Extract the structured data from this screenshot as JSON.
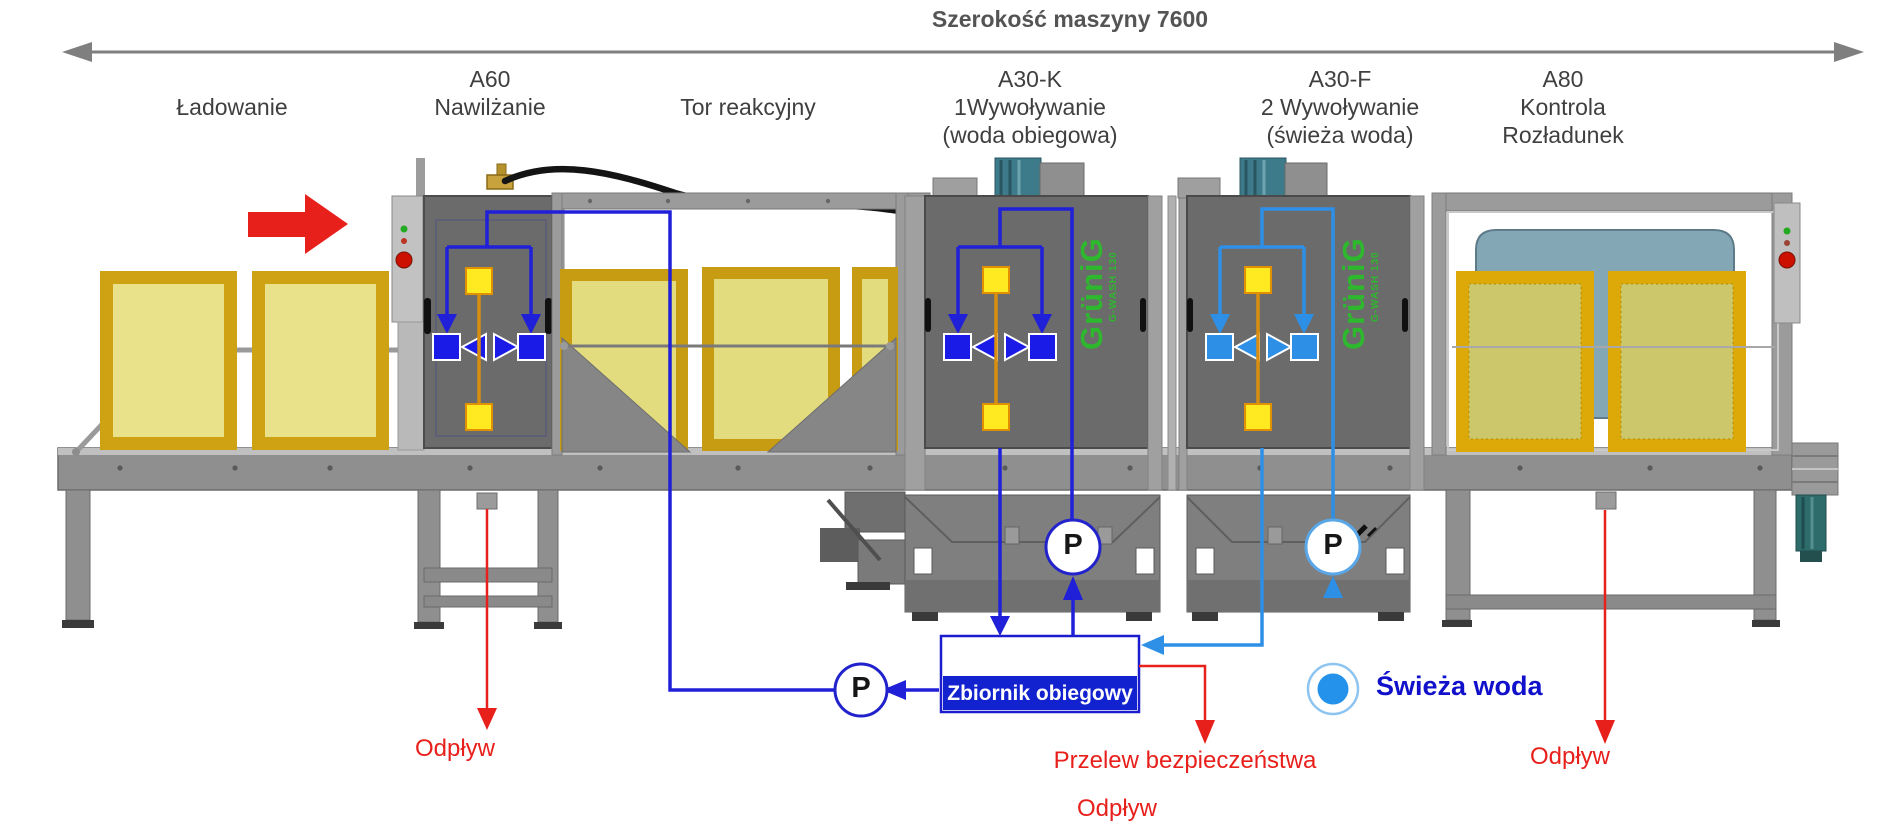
{
  "header": {
    "dimension_label": "Szerokość maszyny 7600"
  },
  "section_labels": {
    "loading": {
      "name": "Ładowanie"
    },
    "a60": {
      "code": "A60",
      "name": "Nawilżanie"
    },
    "reaction": {
      "name": "Tor reakcyjny"
    },
    "a30k": {
      "code": "A30-K",
      "name": "1Wywoływanie",
      "note": "(woda obiegowa)"
    },
    "a30f": {
      "code": "A30-F",
      "name": "2 Wywoływanie",
      "note": "(świeża woda)"
    },
    "a80": {
      "code": "A80",
      "name1": "Kontrola",
      "name2": "Rozładunek"
    }
  },
  "branding": {
    "logo": "GrüniG",
    "model": "G-WASH 130"
  },
  "pumps": {
    "label": "P"
  },
  "water": {
    "tank_label": "Zbiornik obiegowy",
    "fresh_water_label": "Świeża woda",
    "overflow_label": "Przelew bezpieczeństwa",
    "overflow_drain_label": "Odpływ",
    "drain_a60_label": "Odpływ",
    "drain_a80_label": "Odpływ"
  },
  "colors": {
    "circulating_water_blue": "#2020d8",
    "fresh_water_blue": "#2e8fe6",
    "drain_red": "#e8201c",
    "tank_fill_blue": "#1322cf",
    "logo_green": "#2db82d",
    "frame_yellow": "#d7a50f"
  }
}
